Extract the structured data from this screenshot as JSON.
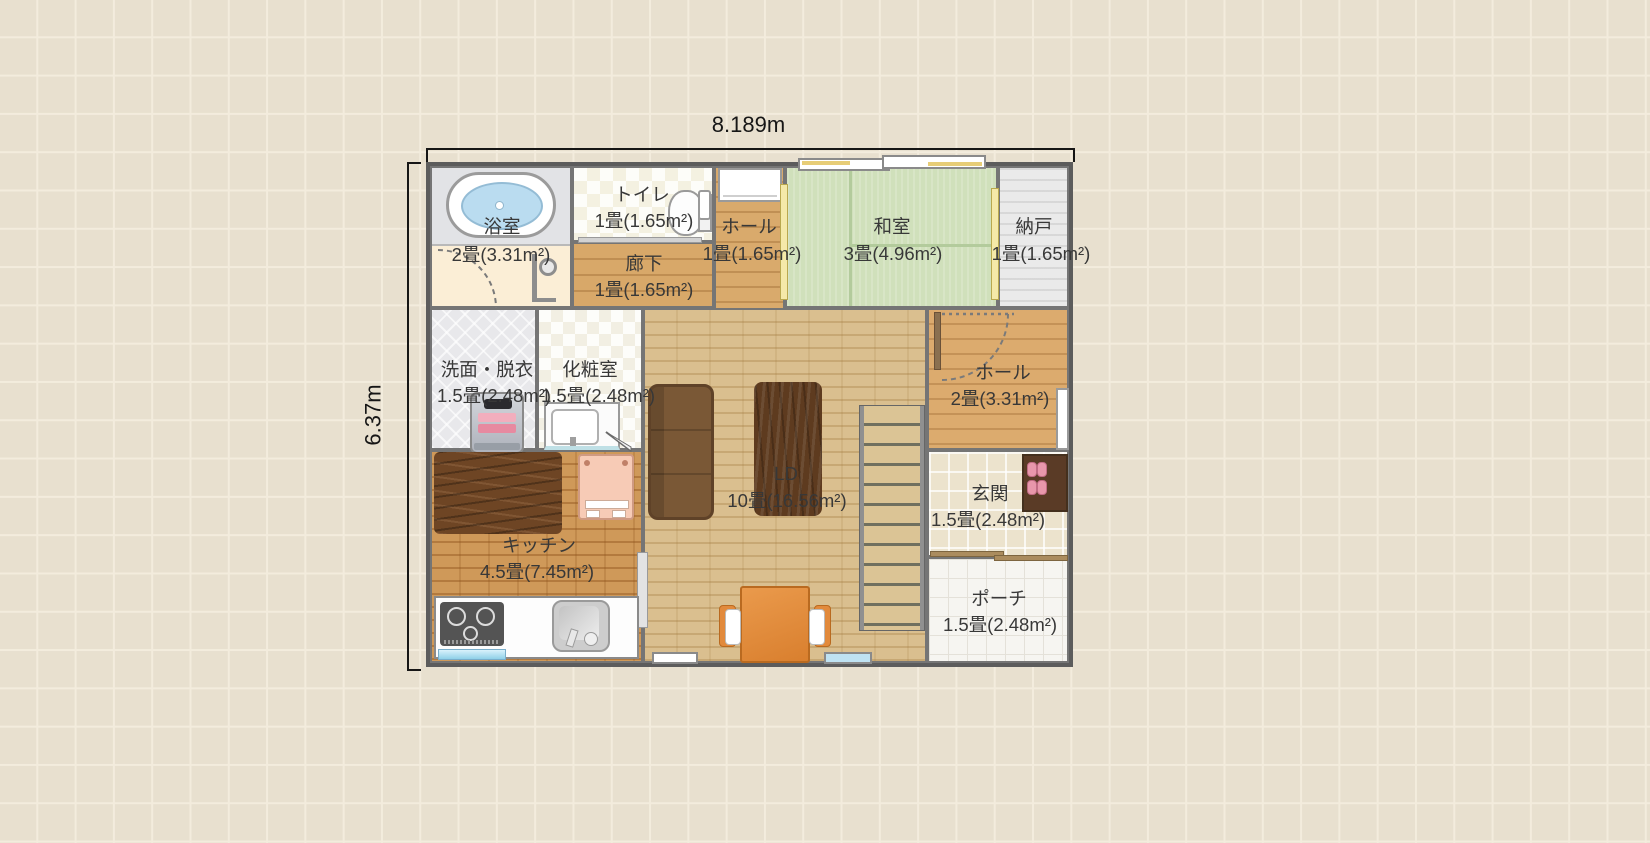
{
  "app": {
    "type": "floor-plan-viewer"
  },
  "dims": {
    "width": "8.189m",
    "height": "6.37m"
  },
  "rooms": [
    {
      "id": "bath",
      "name": "浴室",
      "area": "2畳(3.31m²)"
    },
    {
      "id": "toilet",
      "name": "トイレ",
      "area": "1畳(1.65m²)"
    },
    {
      "id": "hall-upper",
      "name": "ホール",
      "area": "1畳(1.65m²)"
    },
    {
      "id": "washitsu",
      "name": "和室",
      "area": "3畳(4.96m²)"
    },
    {
      "id": "nando",
      "name": "納戸",
      "area": "1畳(1.65m²)"
    },
    {
      "id": "rouka",
      "name": "廊下",
      "area": "1畳(1.65m²)"
    },
    {
      "id": "senmen",
      "name": "洗面・脱衣",
      "area": "1.5畳(2.48m²)"
    },
    {
      "id": "keshou",
      "name": "化粧室",
      "area": "1.5畳(2.48m²)"
    },
    {
      "id": "ld",
      "name": "LD",
      "area": "10畳(16.56m²)"
    },
    {
      "id": "hall-entry",
      "name": "ホール",
      "area": "2畳(3.31m²)"
    },
    {
      "id": "genkan",
      "name": "玄関",
      "area": "1.5畳(2.48m²)"
    },
    {
      "id": "kitchen",
      "name": "キッチン",
      "area": "4.5畳(7.45m²)"
    },
    {
      "id": "porch",
      "name": "ポーチ",
      "area": "1.5畳(2.48m²)"
    }
  ],
  "fixtures": [
    "bathtub-icon",
    "bath-faucet-icon",
    "toilet-icon",
    "toilet-sink-icon",
    "entry-door-icon",
    "sliding-window-icon",
    "sliding-door-icon",
    "washing-machine-icon",
    "vanity-sink-icon",
    "kitchen-rug-icon",
    "pet-bed-icon",
    "stove-icon",
    "kitchen-sink-icon",
    "kitchen-window-icon",
    "sofa-icon",
    "living-rug-icon",
    "stairs-icon",
    "dining-table-icon",
    "chair-icon",
    "door-arc-icon",
    "shoe-cabinet-icon",
    "slippers-icon",
    "window-icon"
  ],
  "colors": {
    "background": "#e8e0cf",
    "wall": "#5c5c5c",
    "tatami": "#d0e0bb",
    "wood": "#d8a869",
    "ld_floor": "#dabf8f",
    "kitchen_floor": "#cf9959",
    "table_accent": "#e08c3e",
    "water": "#badcf0"
  }
}
